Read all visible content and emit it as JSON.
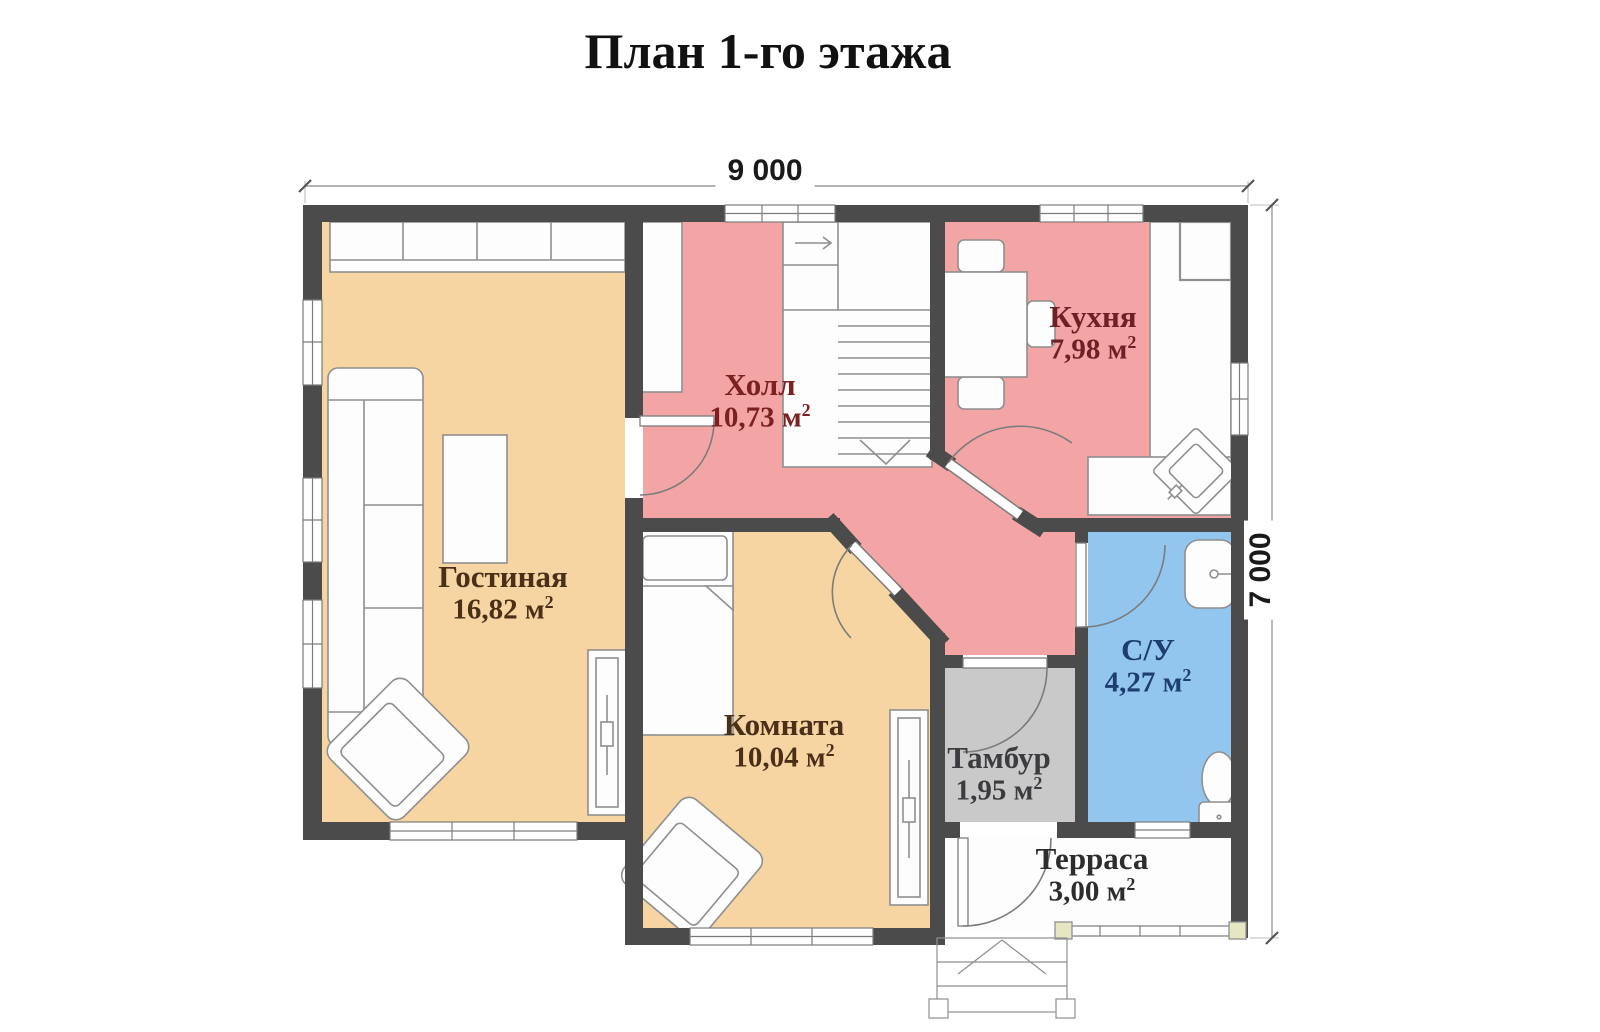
{
  "title": "План 1-го этажа",
  "dimensions": {
    "width": "9 000",
    "height": "7 000"
  },
  "units": {
    "sq_prefix": " м",
    "sq_exp": "2"
  },
  "rooms": [
    {
      "name": "Гостиная",
      "area_value": "16,82",
      "color": "#f6d5a2"
    },
    {
      "name": "Холл",
      "area_value": "10,73",
      "color": "#f3a5a5"
    },
    {
      "name": "Кухня",
      "area_value": "7,98",
      "color": "#f3a5a5"
    },
    {
      "name": "Комната",
      "area_value": "10,04",
      "color": "#f6d5a2"
    },
    {
      "name": "С/У",
      "area_value": "4,27",
      "color": "#92c6ef"
    },
    {
      "name": "Тамбур",
      "area_value": "1,95",
      "color": "#c9c9c9"
    },
    {
      "name": "Терраса",
      "area_value": "3,00",
      "color": "#fdfdfd"
    }
  ],
  "colors": {
    "wall": "#4b4b4b",
    "furniture_line": "#8f8f8f",
    "door_line": "#7c7c7c",
    "dimension_line": "#9a9a9a",
    "label_living": "#4a3018",
    "label_hall": "#7c2121",
    "label_kitchen": "#6d2026",
    "label_room": "#4a3018",
    "label_wc": "#1e3e70",
    "label_tambour": "#3c3c40",
    "label_terrace": "#2d2d2d",
    "title_color": "#111111"
  },
  "furniture": [
    "staircase",
    "closet",
    "wall-cabinet",
    "sofa",
    "coffee-table",
    "armchair",
    "radiator",
    "bed",
    "dining-table",
    "chair",
    "kitchen-counter",
    "fridge",
    "kitchen-sink",
    "bathroom-sink",
    "toilet",
    "terrace-rail",
    "porch-steps"
  ]
}
